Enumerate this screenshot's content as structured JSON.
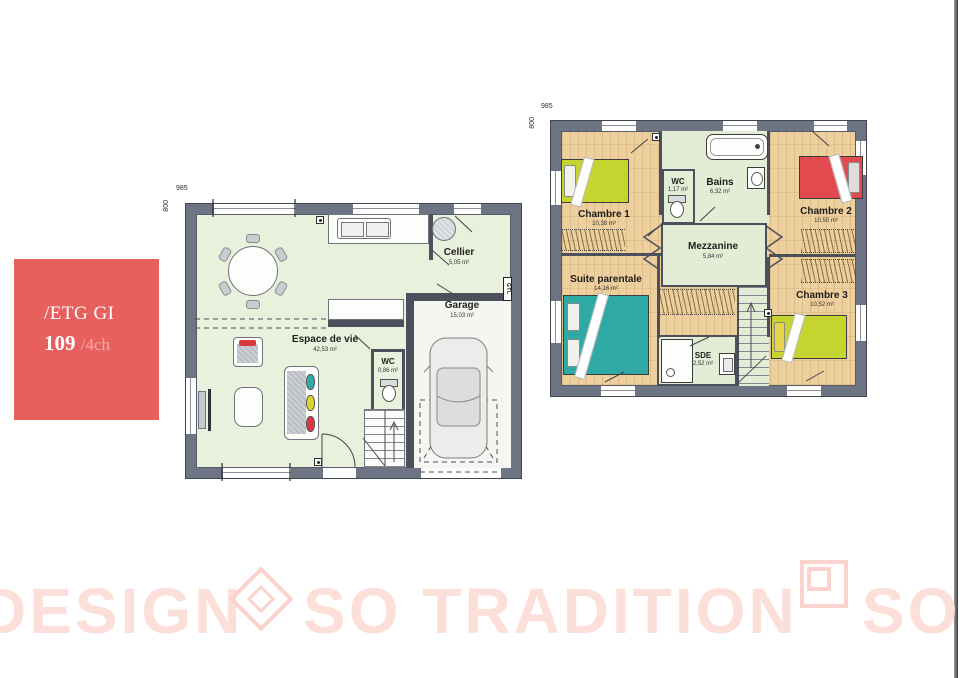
{
  "info_card": {
    "line1": "/ETG GI",
    "number": "109",
    "variant": "/4ch"
  },
  "ground_floor": {
    "dims": {
      "width": "985",
      "height": "800"
    },
    "rooms": {
      "espace": {
        "name": "Espace de vie",
        "area": "42,53 m²"
      },
      "cellier": {
        "name": "Cellier",
        "area": "5,05 m²"
      },
      "garage": {
        "name": "Garage",
        "area": "15,03 m²"
      },
      "wc": {
        "name": "WC",
        "area": "0,86 m²"
      }
    },
    "gtl_label": "GTL"
  },
  "upper_floor": {
    "dims": {
      "width": "985",
      "height": "800"
    },
    "rooms": {
      "chambre1": {
        "name": "Chambre 1",
        "area": "10,38 m²"
      },
      "wc": {
        "name": "WC",
        "area": "1,17 m²"
      },
      "bains": {
        "name": "Bains",
        "area": "6,32 m²"
      },
      "chambre2": {
        "name": "Chambre 2",
        "area": "10,50 m²"
      },
      "mezzanine": {
        "name": "Mezzanine",
        "area": "5,84 m²"
      },
      "suite": {
        "name": "Suite parentale",
        "area": "14,16 m²"
      },
      "sde": {
        "name": "SDE",
        "area": "2,52 m²"
      },
      "chambre3": {
        "name": "Chambre 3",
        "area": "10,52 m²"
      }
    }
  },
  "watermark": {
    "word1": "DESIGN",
    "word2": "SO TRADITION",
    "word3": "SO"
  },
  "colors": {
    "card_red": "#e7605e",
    "wall_gray": "#6d7483",
    "floor_green": "#e9f0dc",
    "wood": "#edd09e",
    "bed_green": "#c5d42f",
    "bed_red": "#e14b50",
    "bed_teal": "#2fa9a3",
    "watermark_pink": "#fcdfd9"
  }
}
